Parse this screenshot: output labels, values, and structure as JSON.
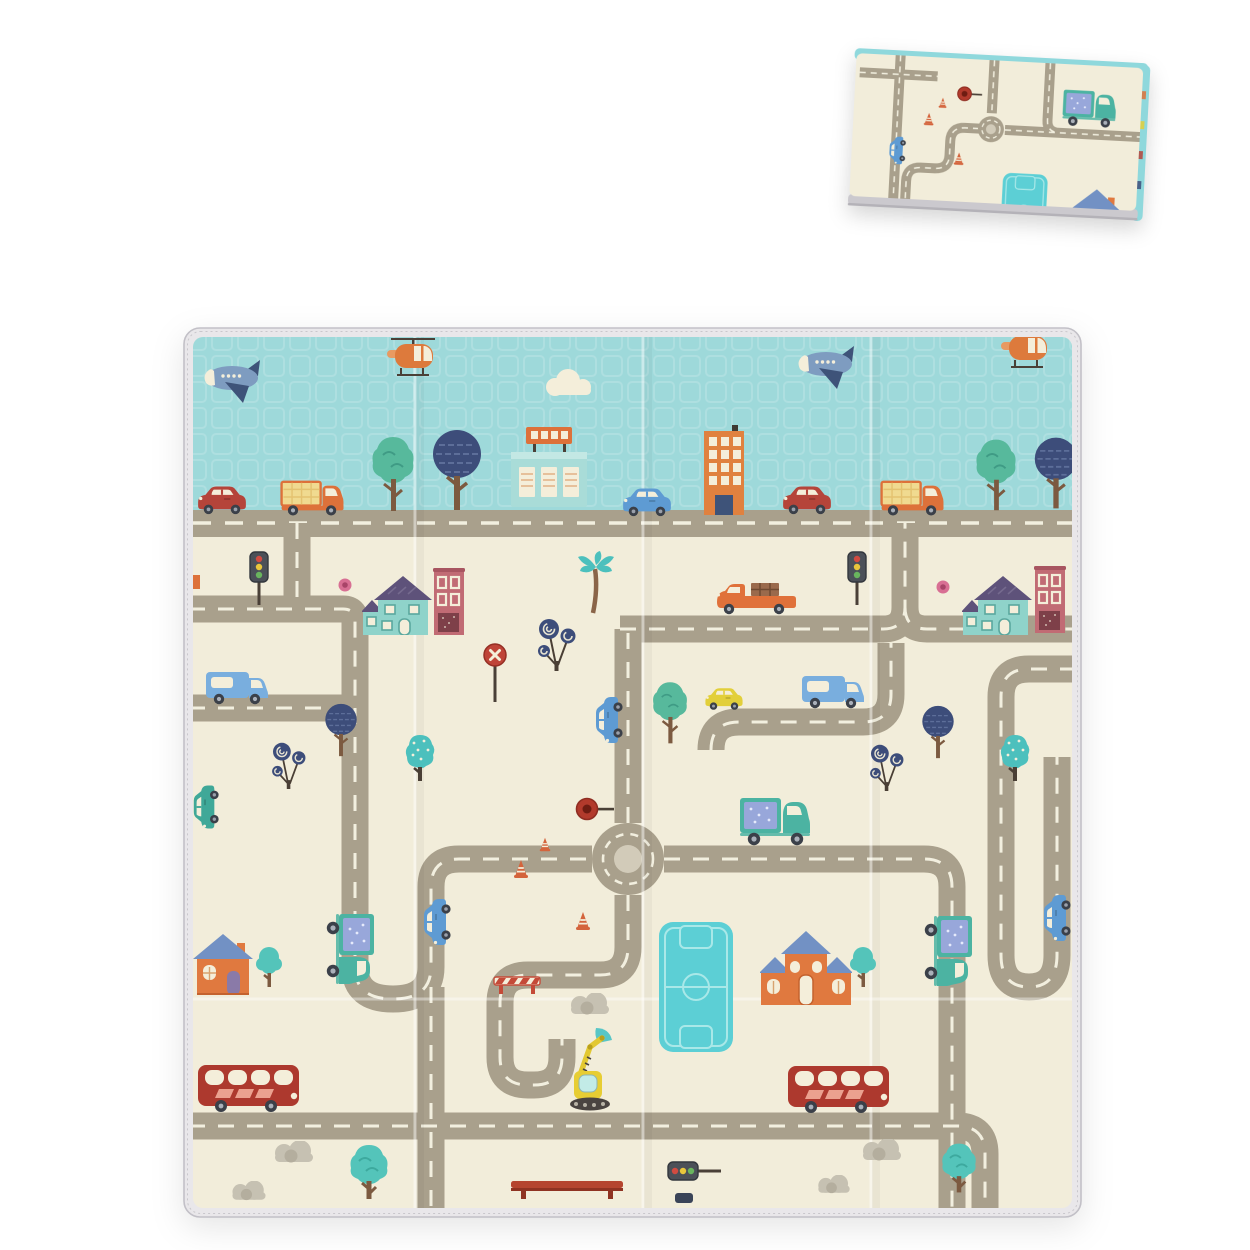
{
  "page": {
    "background_color": "#ffffff",
    "aria_label_main": "Unfolded baby play mat printed with a cartoon town road map",
    "aria_label_folded": "Same play mat shown folded, viewed from above"
  },
  "palette": {
    "mat_cream": "#f2edda",
    "sky_blue": "#9ed9da",
    "road_gray": "#a9a08c",
    "road_dash": "#f2efdf",
    "roundabout_island": "#d2cbb9",
    "trim_gray": "#e9e7ea",
    "trim_edge": "#c2c0c7",
    "folded_edge_blue": "#8fd8dc",
    "folded_bottom_gray": "#cbc9ce",
    "accent_red": "#b5443a",
    "bus_red": "#ad392e",
    "accent_orange": "#dd713a",
    "accent_teal": "#4cb3a2",
    "accent_navy": "#3d4d7a",
    "accent_yellow": "#e2cf3a",
    "pool_teal": "#5ccfd5",
    "roof_purple": "#5e527a",
    "roof_blue": "#7291c4",
    "building_rose": "#c16b74"
  },
  "main_mat": {
    "sky_band": {
      "color": "#9ed9da",
      "elements": [
        {
          "name": "airplane",
          "count": 2,
          "color": "#7e9cc0"
        },
        {
          "name": "helicopter",
          "count": 2,
          "color": "#dd7a3c"
        },
        {
          "name": "cloud",
          "count": 1,
          "color": "#f4eeda"
        },
        {
          "name": "red car",
          "count": 2,
          "color": "#b5443a"
        },
        {
          "name": "orange cargo van",
          "count": 2,
          "color": "#dd713a"
        },
        {
          "name": "blue car",
          "count": 1,
          "color": "#5e9bd3"
        },
        {
          "name": "leafy green tree",
          "count": 2,
          "color": "#57b99c"
        },
        {
          "name": "round navy tree",
          "count": 2,
          "color": "#3d4d7a"
        },
        {
          "name": "teal station building",
          "count": 1,
          "color": "#a9dcd8"
        },
        {
          "name": "orange tower building",
          "count": 1,
          "color": "#e0813f"
        },
        {
          "name": "highway road with dashes",
          "count": 1,
          "color": "#a9a08c"
        }
      ]
    },
    "city": {
      "background": "#f2edda",
      "elements": [
        {
          "name": "roundabout",
          "count": 1
        },
        {
          "name": "teal house with purple roof",
          "count": 2
        },
        {
          "name": "rose-red tall building",
          "count": 2
        },
        {
          "name": "orange house with blue roof",
          "count": 2
        },
        {
          "name": "teal pool playfield",
          "count": 1
        },
        {
          "name": "red double-decker bus",
          "count": 2
        },
        {
          "name": "teal box truck",
          "count": 3
        },
        {
          "name": "blue delivery van",
          "count": 2
        },
        {
          "name": "blue car",
          "count": 3
        },
        {
          "name": "yellow car",
          "count": 1
        },
        {
          "name": "teal car",
          "count": 1
        },
        {
          "name": "orange pickup with crate",
          "count": 1
        },
        {
          "name": "yellow excavator",
          "count": 1
        },
        {
          "name": "traffic light",
          "count": 3
        },
        {
          "name": "stop sign",
          "count": 1
        },
        {
          "name": "red round sign",
          "count": 1
        },
        {
          "name": "traffic cone",
          "count": 3
        },
        {
          "name": "striped barrier",
          "count": 1
        },
        {
          "name": "red bench",
          "count": 1
        },
        {
          "name": "navy round tree",
          "count": 2
        },
        {
          "name": "spiral lollipop tree",
          "count": 3
        },
        {
          "name": "dotted teal tree",
          "count": 2
        },
        {
          "name": "small teal tree",
          "count": 2
        },
        {
          "name": "big teal tree",
          "count": 2
        },
        {
          "name": "green leafy tree",
          "count": 1
        },
        {
          "name": "palm tree",
          "count": 1
        },
        {
          "name": "pink lollipop dot",
          "count": 2
        },
        {
          "name": "gray bush",
          "count": 5
        }
      ]
    }
  },
  "folded_mat": {
    "elements": [
      {
        "name": "roundabout",
        "count": 1
      },
      {
        "name": "teal box truck",
        "count": 1
      },
      {
        "name": "blue car",
        "count": 1
      },
      {
        "name": "red round sign",
        "count": 1
      },
      {
        "name": "traffic cone",
        "count": 3
      },
      {
        "name": "teal pool playfield",
        "count": 1
      },
      {
        "name": "orange house with blue roof",
        "count": 1
      },
      {
        "name": "blue folded edge",
        "count": 1
      },
      {
        "name": "gray bottom trim",
        "count": 1
      }
    ]
  }
}
